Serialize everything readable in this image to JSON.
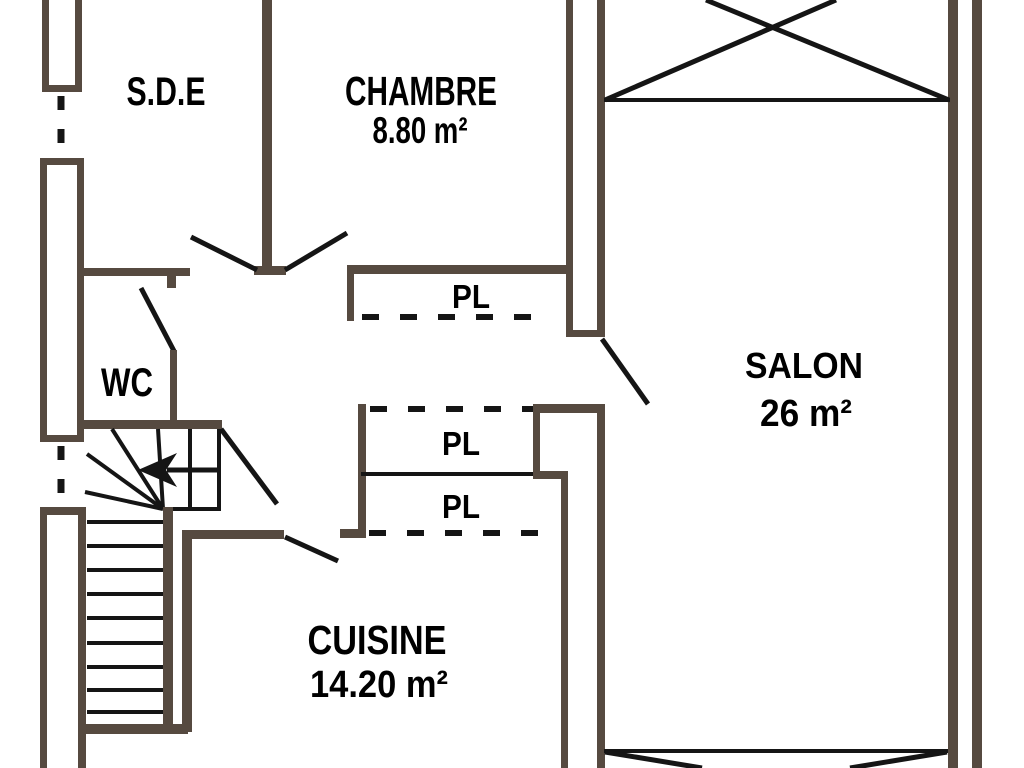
{
  "colors": {
    "wall": "#564a40",
    "line": "#151515",
    "background": "#ffffff"
  },
  "rooms": {
    "sde": {
      "name": "S.D.E"
    },
    "chambre": {
      "name": "CHAMBRE",
      "area": "8.80 m²"
    },
    "salon": {
      "name": "SALON",
      "area": "26 m²"
    },
    "wc": {
      "name": "WC"
    },
    "cuisine": {
      "name": "CUISINE",
      "area": "14.20 m²"
    }
  },
  "closets": {
    "chambre_closet": {
      "label": "PL"
    },
    "hall_closet_upper": {
      "label": "PL"
    },
    "hall_closet_lower": {
      "label": "PL"
    }
  }
}
